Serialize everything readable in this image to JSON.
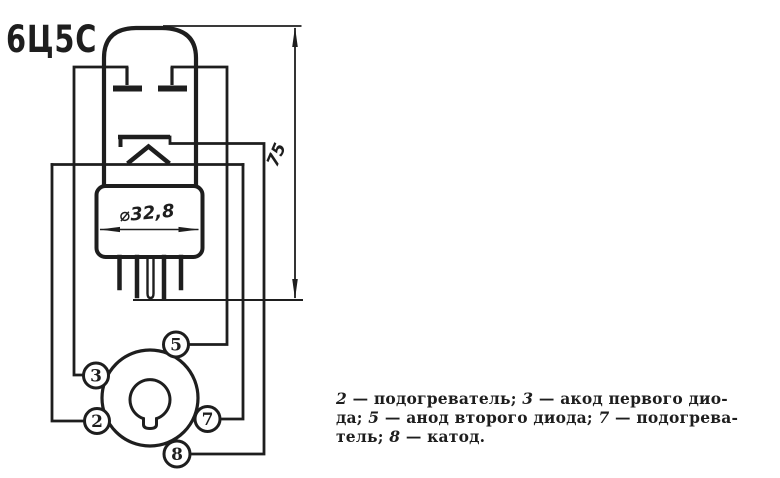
{
  "page": {
    "background": "#ffffff",
    "ink": "#1e1e1e"
  },
  "title": "6Ц5С",
  "drawing": {
    "diameter_label": "⌀32,8",
    "height_label": "75"
  },
  "socket": {
    "pins": [
      {
        "label": "5"
      },
      {
        "label": "3"
      },
      {
        "label": "2"
      },
      {
        "label": "7"
      },
      {
        "label": "8"
      }
    ]
  },
  "caption": {
    "lines": [
      [
        {
          "text": "2",
          "em": true
        },
        {
          "text": " — подогреватель; ",
          "em": false
        },
        {
          "text": "3",
          "em": true
        },
        {
          "text": " — акод первого дио-",
          "em": false
        }
      ],
      [
        {
          "text": "да; ",
          "em": false
        },
        {
          "text": "5",
          "em": true
        },
        {
          "text": " — анод второго диода; ",
          "em": false
        },
        {
          "text": "7",
          "em": true
        },
        {
          "text": " — подогрева-",
          "em": false
        }
      ],
      [
        {
          "text": "тель; ",
          "em": false
        },
        {
          "text": "8",
          "em": true
        },
        {
          "text": " — катод.",
          "em": false
        }
      ]
    ]
  }
}
